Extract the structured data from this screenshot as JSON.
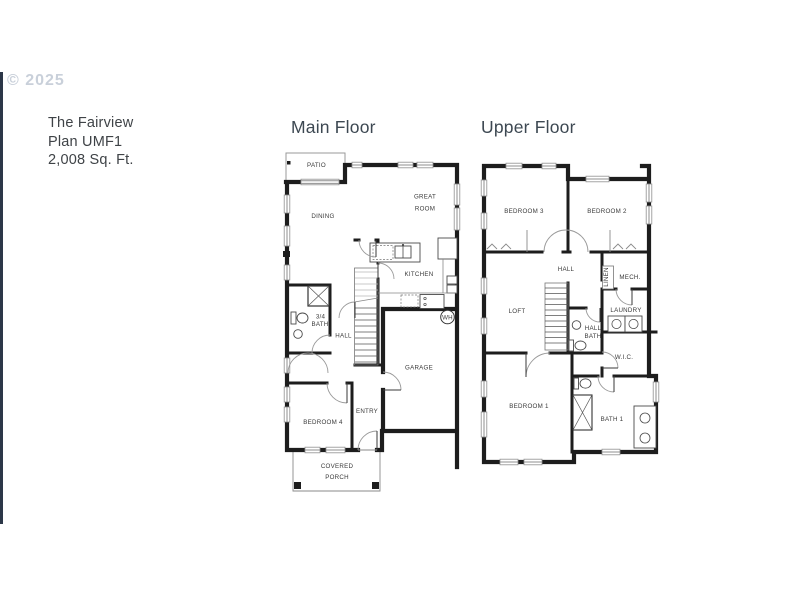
{
  "watermark": "© 2025",
  "info": {
    "line1": "The Fairview",
    "line2": "Plan UMF1",
    "line3": "2,008  Sq. Ft."
  },
  "floors": {
    "main": {
      "title": "Main Floor",
      "rooms": {
        "patio": "PATIO",
        "dining": "DINING",
        "great_room_line1": "GREAT",
        "great_room_line2": "ROOM",
        "kitchen": "KITCHEN",
        "water_heater": "WH",
        "bath_line1": "3/4",
        "bath_line2": "BATH",
        "hall": "HALL",
        "garage": "GARAGE",
        "entry": "ENTRY",
        "bedroom4": "BEDROOM 4",
        "porch_line1": "COVERED",
        "porch_line2": "PORCH"
      }
    },
    "upper": {
      "title": "Upper Floor",
      "rooms": {
        "bedroom3": "BEDROOM 3",
        "bedroom2": "BEDROOM 2",
        "hall": "HALL",
        "linen": "LINEN",
        "mech": "MECH.",
        "loft": "LOFT",
        "laundry": "LAUNDRY",
        "hall_bath_line1": "HALL",
        "hall_bath_line2": "BATH",
        "wic": "W.I.C.",
        "bedroom1": "BEDROOM 1",
        "bath1": "BATH 1"
      }
    }
  },
  "colors": {
    "wall": "#1d1d1d",
    "label": "#3a3a3a",
    "title": "#3d4852",
    "watermark": "#c9d0da",
    "photo_edge": "#2c3748"
  }
}
